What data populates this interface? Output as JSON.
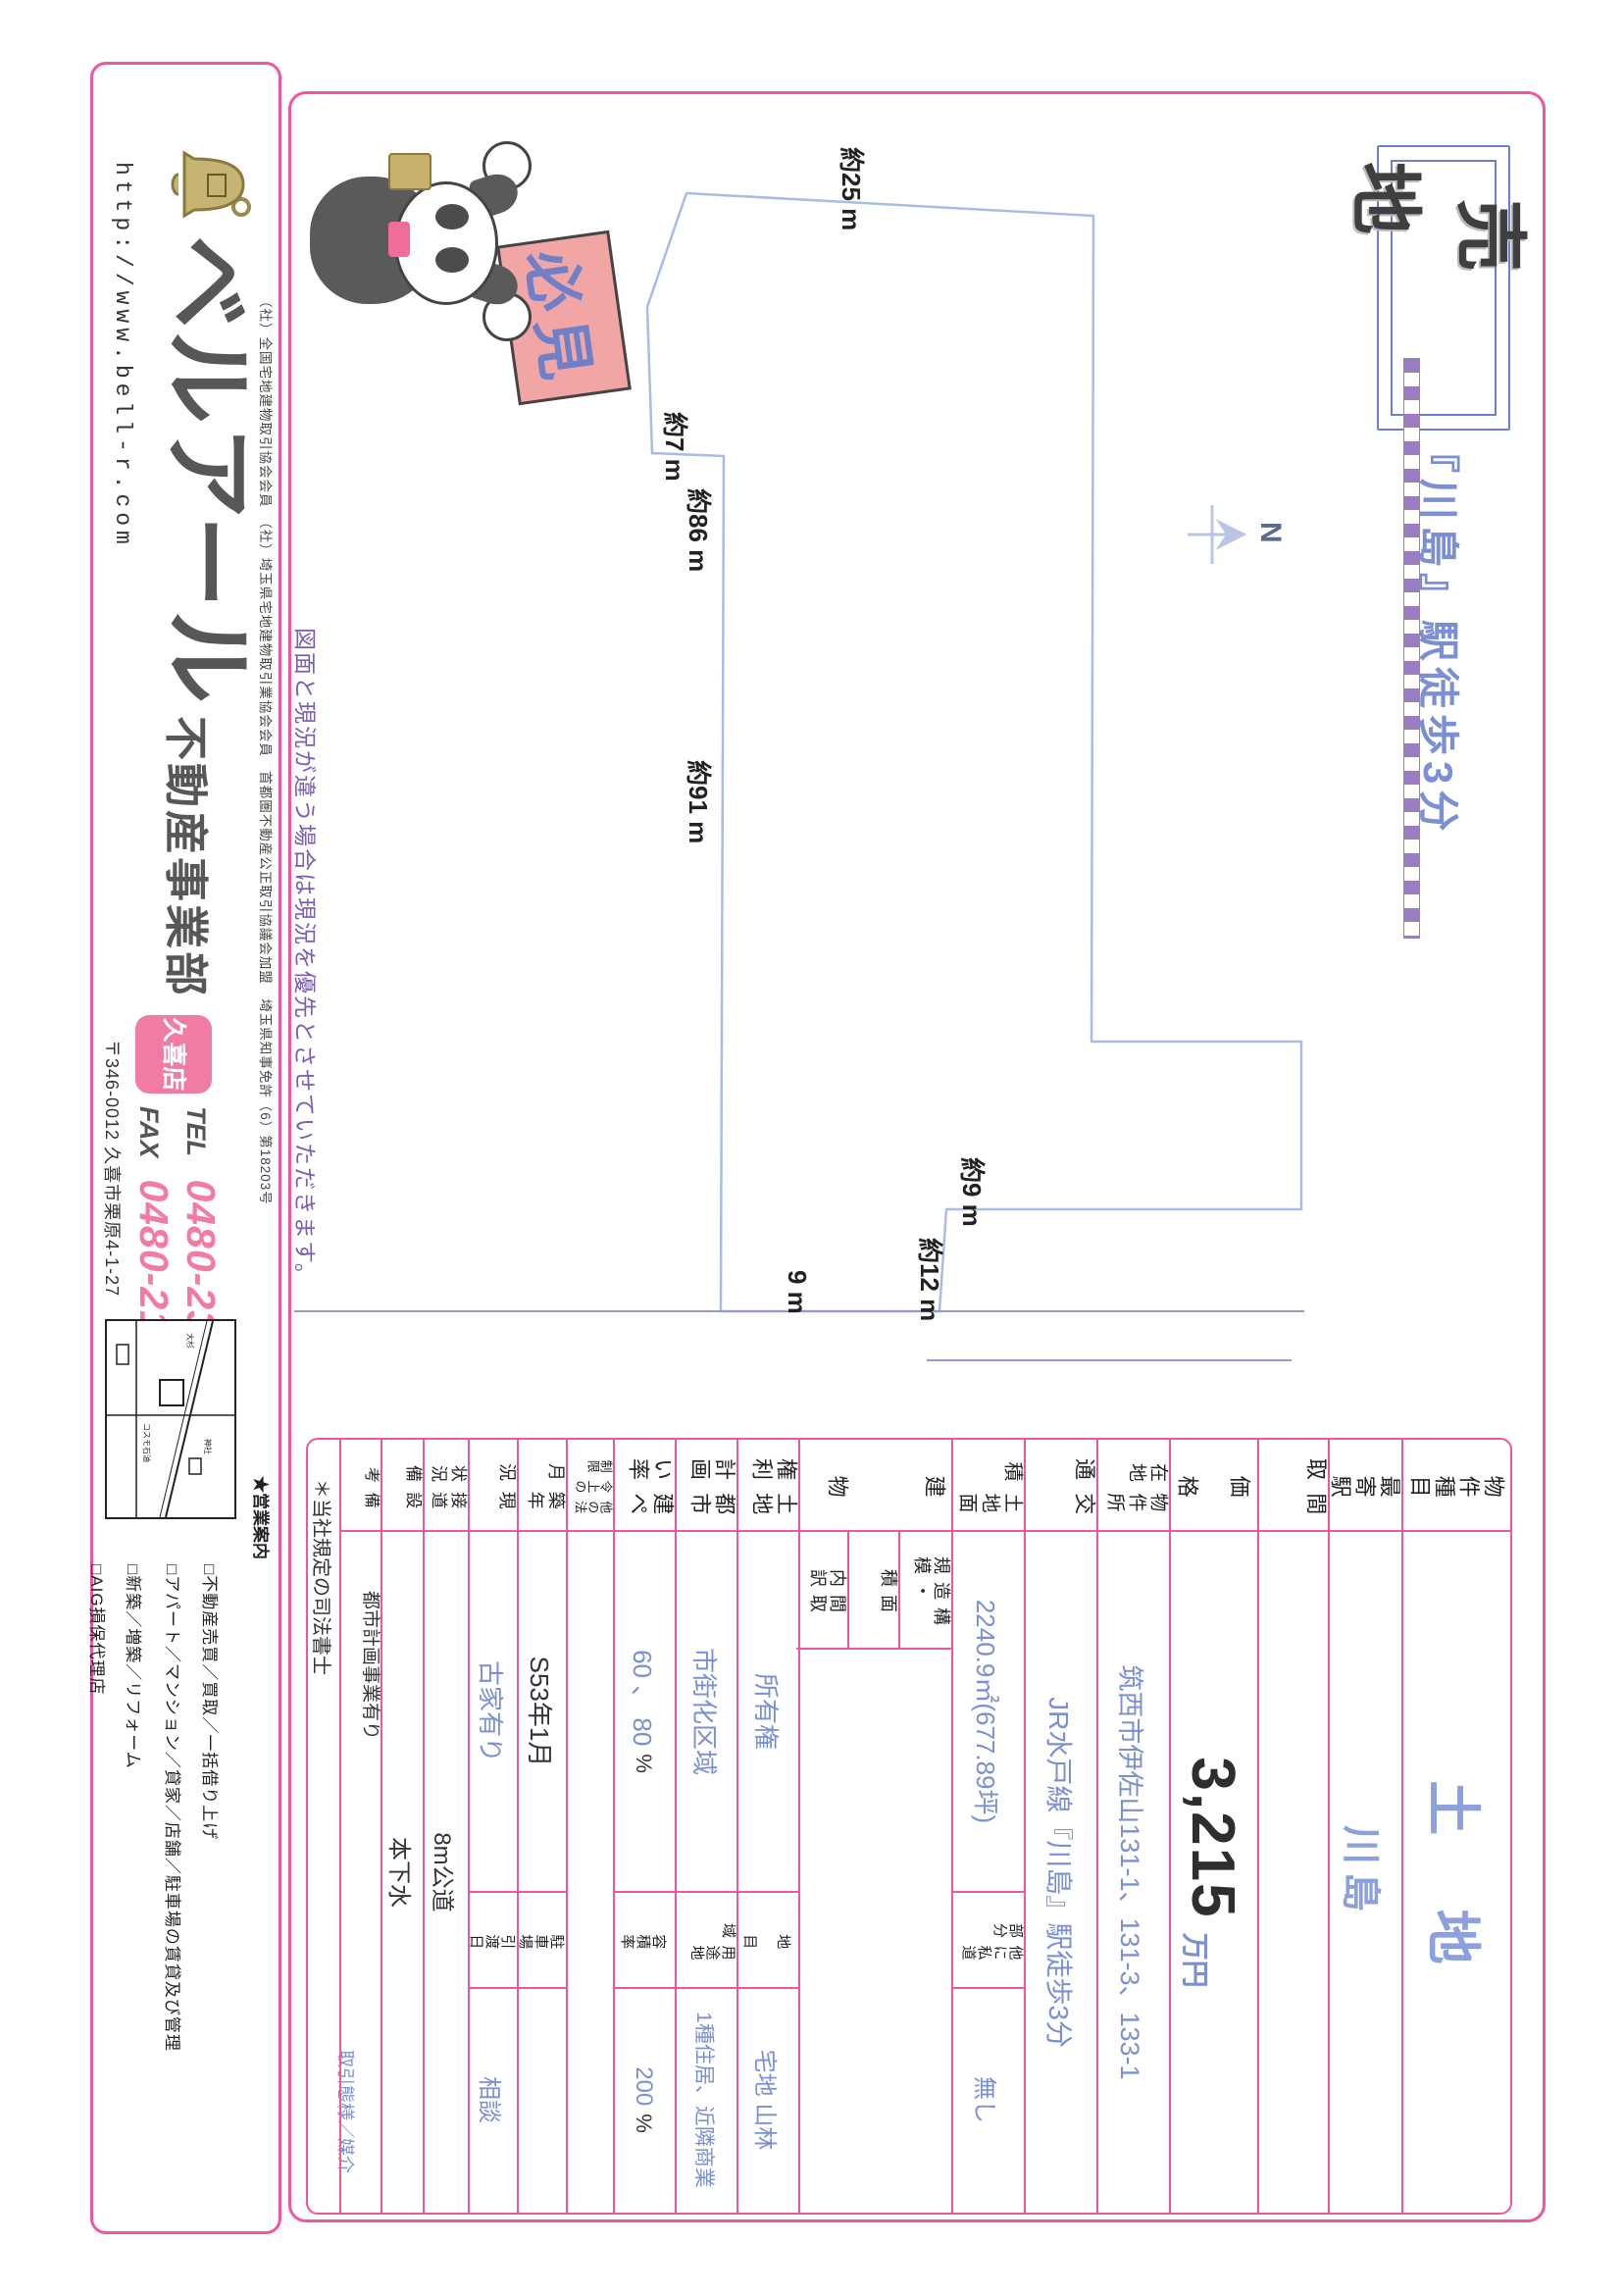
{
  "header": {
    "sale_badge": "売地",
    "catch": "『川島』駅徒歩3分"
  },
  "diagram": {
    "labels": {
      "top": "約25 m",
      "seg7": "約7 m",
      "seg86": "約86 m",
      "seg91": "約91 m",
      "seg9": "約9 m",
      "seg12": "約12 m",
      "road": "9 m",
      "north": "N"
    },
    "sign": "必見",
    "disclaimer": "図面と現況が違う場合は現況を優先とさせていただきます。"
  },
  "table": {
    "rows": {
      "r1": {
        "h": "物件種目",
        "v": "土 地"
      },
      "r2": {
        "h": "最寄駅",
        "v": "川島"
      },
      "r3": {
        "h": "間 取",
        "v": ""
      },
      "r4": {
        "h": "価 格",
        "v": "3,215",
        "unit": "万円"
      },
      "r5": {
        "h": "物件所在地",
        "v": "筑西市伊佐山131-1、131-3、133-1"
      },
      "r6": {
        "h": "交 通",
        "v": "JR水戸線『川島』駅徒歩3分"
      },
      "r7": {
        "h": "土地面積",
        "v": "2240.9㎡(677.89坪)",
        "sh": "他に私道部分",
        "v2": "無し"
      },
      "r8": {
        "h": "建 物",
        "sub1": "構造・規模",
        "sub2": "面 積",
        "sub3": "間取内訳"
      },
      "r9": {
        "h": "土地権利",
        "v": "所有権",
        "sh": "地 目",
        "v2": "宅地 山林"
      },
      "r10": {
        "h": "都市計画",
        "v": "市街化区域",
        "sh": "用途地域",
        "v2": "1種住居、近隣商業"
      },
      "r11": {
        "h": "建ぺい率",
        "v": "60 、 80",
        "pct": "%",
        "sh": "容積率",
        "v2": "200",
        "pct2": "%"
      },
      "r12": {
        "h": "他の法令上の制限",
        "v": ""
      },
      "r13": {
        "h": "築年月",
        "v": "S53年1月",
        "sh": "駐車場",
        "v2": ""
      },
      "r14": {
        "h": "現 況",
        "v": "古家有り",
        "sh": "引渡日",
        "v2": "相談"
      },
      "r15": {
        "h": "接道状況",
        "v": "8m公道"
      },
      "r16": {
        "h": "設 備",
        "v": "本下水"
      },
      "r17": {
        "h": "備 考",
        "v": "都市計画事業有り",
        "v2": "取引態様／媒介"
      },
      "r18": {
        "v": "＊当社規定の司法書士"
      }
    }
  },
  "company": {
    "memberships": "（社）全国宅地建物取引協会会員　（社）埼玉県宅地建物取引業協会会員　首都圏不動産公正取引協議会加盟　埼玉県知事免許（6）第18203号",
    "logo": "ベルアール",
    "url": "http://www.bell-r.com",
    "dept": "不動産事業部",
    "branch": "久喜店",
    "tel_label": "TEL",
    "tel": "0480-23-8244",
    "fax_label": "FAX",
    "fax": "0480-21-6304",
    "address": "〒346-0012 久喜市栗原4-1-27",
    "map_labels": [
      "神社",
      "コスモ石油",
      "大杉"
    ],
    "services_title": "★営業案内",
    "services": [
      "□不動産売買／買取／一括借り上げ",
      "□アパート／マンション／貸家／店舗／駐車場の賃貸及び管理",
      "□新築／増築／リフォーム",
      "□AIG損保代理店"
    ]
  }
}
